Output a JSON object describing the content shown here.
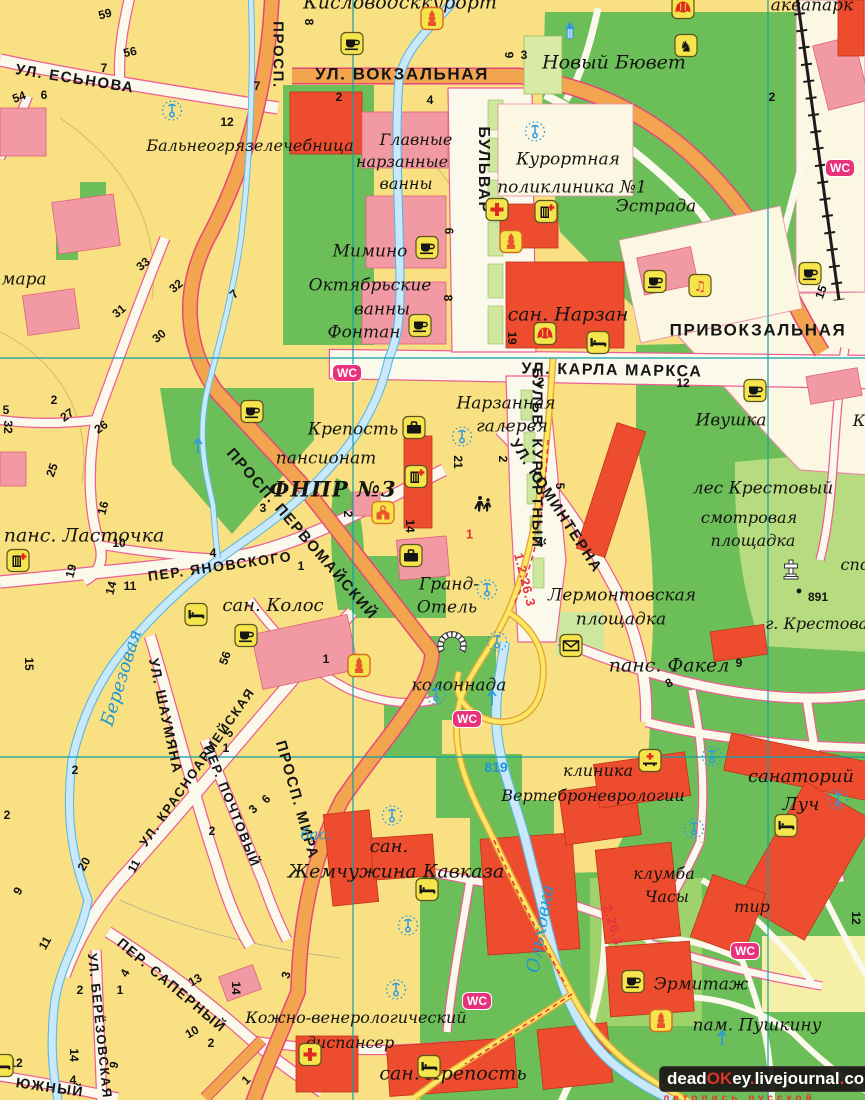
{
  "wc_label": "WC",
  "watermark": {
    "segments": [
      {
        "text": "dead",
        "color": "#ffffff"
      },
      {
        "text": "OK",
        "color": "#e03227"
      },
      {
        "text": "ey",
        "color": "#ffffff"
      },
      {
        "text": ".",
        "color": "#e03227"
      },
      {
        "text": "livejournal",
        "color": "#ffffff"
      },
      {
        "text": ".",
        "color": "#e03227"
      },
      {
        "text": "com",
        "color": "#ffffff"
      }
    ],
    "subtitle": "летопись русской усадьбы"
  },
  "streets": [
    {
      "id": "ul-esnova",
      "t": "УЛ. ЕСЬНОВА",
      "x": 75,
      "y": 79,
      "r": 9,
      "s": 15
    },
    {
      "id": "prosp-top",
      "t": "ПРОСП.",
      "x": 278,
      "y": 55,
      "r": 90,
      "s": 15
    },
    {
      "id": "ul-vokzalnaya",
      "t": "УЛ. ВОКЗАЛЬНАЯ",
      "x": 402,
      "y": 74,
      "r": 0,
      "s": 17
    },
    {
      "id": "bulvar",
      "t": "БУЛЬВАР",
      "x": 483,
      "y": 170,
      "r": 90,
      "s": 16
    },
    {
      "id": "bulv-kurortny",
      "t": "БУЛЬВ. КУРОРТНЫЙ",
      "x": 537,
      "y": 458,
      "r": 90,
      "s": 15
    },
    {
      "id": "ul-karla-marksa",
      "t": "УЛ. КАРЛА МАРКСА",
      "x": 612,
      "y": 371,
      "r": 1,
      "s": 16
    },
    {
      "id": "privokzalnaya",
      "t": "ПРИВОКЗАЛЬНАЯ",
      "x": 758,
      "y": 330,
      "r": 0,
      "s": 17
    },
    {
      "id": "ul-kominterna",
      "t": "УЛ. КОМИНТЕРНА",
      "x": 556,
      "y": 506,
      "r": 57,
      "s": 15
    },
    {
      "id": "prosp-pervomaisky",
      "t": "ПРОСП. ПЕРВОМАЙСКИЙ",
      "x": 302,
      "y": 534,
      "r": 49,
      "s": 15
    },
    {
      "id": "prosp-mira",
      "t": "ПРОСП. МИРА",
      "x": 297,
      "y": 800,
      "r": 74,
      "s": 15
    },
    {
      "id": "per-yanovskogo",
      "t": "ПЕР. ЯНОВСКОГО",
      "x": 220,
      "y": 566,
      "r": -8,
      "s": 14
    },
    {
      "id": "ul-shaumyana",
      "t": "УЛ. ШАУМЯНА",
      "x": 166,
      "y": 716,
      "r": 78,
      "s": 14
    },
    {
      "id": "ul-krasnoarmeyskaya",
      "t": "УЛ. КРАСНОАРМЕЙСКАЯ",
      "x": 197,
      "y": 767,
      "r": -55,
      "s": 13
    },
    {
      "id": "per-pochtovy",
      "t": "ПЕР. ПОЧТОВЫЙ",
      "x": 232,
      "y": 806,
      "r": 68,
      "s": 13
    },
    {
      "id": "per-saperny",
      "t": "ПЕР. САПЕРНЫЙ",
      "x": 172,
      "y": 985,
      "r": 40,
      "s": 14
    },
    {
      "id": "ul-berezovskaya",
      "t": "УЛ. БЕРЁЗОВСКАЯ",
      "x": 100,
      "y": 1026,
      "r": 84,
      "s": 13
    },
    {
      "id": "yuzhny",
      "t": "ЮЖНЫЙ",
      "x": 50,
      "y": 1087,
      "r": 8,
      "s": 14
    }
  ],
  "places": [
    {
      "id": "kislovodskkurort",
      "t": "Кисловодсккурорт",
      "x": 400,
      "y": 3,
      "s": 19
    },
    {
      "id": "balneo",
      "t": "Бальнеогрязелечебница",
      "x": 250,
      "y": 146,
      "s": 16
    },
    {
      "id": "glavnye",
      "t": "Главные",
      "x": 416,
      "y": 140,
      "s": 16
    },
    {
      "id": "narzannye",
      "t": "нарзанные",
      "x": 402,
      "y": 162,
      "s": 16
    },
    {
      "id": "vanny-1",
      "t": "ванны",
      "x": 406,
      "y": 184,
      "s": 16
    },
    {
      "id": "novy-byuvet",
      "t": "Новый Бювет",
      "x": 614,
      "y": 63,
      "s": 19
    },
    {
      "id": "akvapark",
      "t": "аквапарк",
      "x": 812,
      "y": 6,
      "s": 17
    },
    {
      "id": "kurortnaya",
      "t": "Курортная",
      "x": 568,
      "y": 160,
      "s": 17
    },
    {
      "id": "poliklinika",
      "t": "поликлиника №1",
      "x": 572,
      "y": 188,
      "s": 17
    },
    {
      "id": "estrada",
      "t": "Эстрада",
      "x": 656,
      "y": 207,
      "s": 17
    },
    {
      "id": "mimino",
      "t": "Мимино",
      "x": 370,
      "y": 252,
      "s": 17
    },
    {
      "id": "oktyabrskie",
      "t": "Октябрьские",
      "x": 370,
      "y": 286,
      "s": 17
    },
    {
      "id": "vanny-2",
      "t": "ванны",
      "x": 382,
      "y": 310,
      "s": 17
    },
    {
      "id": "fontan",
      "t": "Фонтан",
      "x": 364,
      "y": 333,
      "s": 17
    },
    {
      "id": "san-narzan",
      "t": "сан. Нарзан",
      "x": 568,
      "y": 315,
      "s": 19
    },
    {
      "id": "narzannaya",
      "t": "Нарзанная",
      "x": 506,
      "y": 404,
      "s": 17
    },
    {
      "id": "galereya",
      "t": "галерея",
      "x": 512,
      "y": 427,
      "s": 17
    },
    {
      "id": "ivushka",
      "t": "Ивушка",
      "x": 731,
      "y": 421,
      "s": 17
    },
    {
      "id": "les-krestovy",
      "t": "лес Крестовый",
      "x": 763,
      "y": 489,
      "s": 17
    },
    {
      "id": "krepost",
      "t": "Крепость",
      "x": 353,
      "y": 430,
      "s": 17
    },
    {
      "id": "pansionat",
      "t": "пансионат",
      "x": 326,
      "y": 459,
      "s": 17
    },
    {
      "id": "fnpr",
      "t": "ФНПР №3",
      "x": 333,
      "y": 489,
      "s": 21,
      "c": "place-bold"
    },
    {
      "id": "pans-lastochka",
      "t": "панс. Ласточка",
      "x": 84,
      "y": 536,
      "s": 19
    },
    {
      "id": "san-kolos",
      "t": "сан. Колос",
      "x": 273,
      "y": 606,
      "s": 18
    },
    {
      "id": "smotrovaya",
      "t": "смотровая",
      "x": 749,
      "y": 518,
      "s": 16
    },
    {
      "id": "ploshchadka-1",
      "t": "площадка",
      "x": 753,
      "y": 541,
      "s": 16
    },
    {
      "id": "grand",
      "t": "Гранд-",
      "x": 449,
      "y": 585,
      "s": 17
    },
    {
      "id": "otel",
      "t": "Отель",
      "x": 447,
      "y": 608,
      "s": 17
    },
    {
      "id": "lermontovskaya",
      "t": "Лермонтовская",
      "x": 622,
      "y": 596,
      "s": 17
    },
    {
      "id": "ploshchadka-2",
      "t": "площадка",
      "x": 621,
      "y": 620,
      "s": 17
    },
    {
      "id": "pans-fakel",
      "t": "панс. Факел",
      "x": 669,
      "y": 666,
      "s": 19
    },
    {
      "id": "kolonnada",
      "t": "колоннада",
      "x": 459,
      "y": 686,
      "s": 17
    },
    {
      "id": "klinika",
      "t": "клиника",
      "x": 598,
      "y": 771,
      "s": 16
    },
    {
      "id": "vertebro",
      "t": "Вертеброневрологии",
      "x": 593,
      "y": 796,
      "s": 16
    },
    {
      "id": "sanatoriy",
      "t": "санаторий",
      "x": 801,
      "y": 777,
      "s": 18
    },
    {
      "id": "luch",
      "t": "Луч",
      "x": 801,
      "y": 805,
      "s": 18
    },
    {
      "id": "klumba",
      "t": "клумба",
      "x": 664,
      "y": 874,
      "s": 16
    },
    {
      "id": "chasy",
      "t": "Часы",
      "x": 667,
      "y": 897,
      "s": 16
    },
    {
      "id": "tir",
      "t": "тир",
      "x": 752,
      "y": 907,
      "s": 16
    },
    {
      "id": "san-zh",
      "t": "сан.",
      "x": 389,
      "y": 847,
      "s": 18
    },
    {
      "id": "zhemchuzhina",
      "t": "Жемчужина Кавказа",
      "x": 396,
      "y": 872,
      "s": 19
    },
    {
      "id": "ermitazh",
      "t": "Эрмитаж",
      "x": 701,
      "y": 985,
      "s": 17
    },
    {
      "id": "pam-pushkinu",
      "t": "пам. Пушкину",
      "x": 757,
      "y": 1026,
      "s": 17
    },
    {
      "id": "kozhno",
      "t": "Кожно-венерологический",
      "x": 356,
      "y": 1018,
      "s": 16
    },
    {
      "id": "dispanser",
      "t": "диспансер",
      "x": 350,
      "y": 1043,
      "s": 16
    },
    {
      "id": "san-krepost",
      "t": "сан. Крепость",
      "x": 453,
      "y": 1074,
      "s": 19
    },
    {
      "id": "mara",
      "t": "мара",
      "x": 24,
      "y": 280,
      "s": 17
    },
    {
      "id": "g-krestovaya",
      "t": "г. Крестовая",
      "x": 822,
      "y": 624,
      "s": 16
    },
    {
      "id": "spo",
      "t": "спо",
      "x": 855,
      "y": 565,
      "s": 16
    },
    {
      "id": "k-fragment",
      "t": "К",
      "x": 859,
      "y": 421,
      "s": 16
    },
    {
      "id": "berezovaya",
      "t": "Березовая",
      "x": 122,
      "y": 678,
      "r": -73,
      "s": 18,
      "c": "river"
    },
    {
      "id": "olkhovka",
      "t": "Ольховка",
      "x": 541,
      "y": 929,
      "r": -80,
      "s": 18,
      "c": "river"
    },
    {
      "id": "bas",
      "t": "бас.",
      "x": 316,
      "y": 835,
      "s": 15,
      "c": "river"
    },
    {
      "id": "elev-819",
      "t": "819",
      "x": 496,
      "y": 767,
      "s": 14,
      "c": "elev"
    },
    {
      "id": "route-1-2-26-3",
      "t": "1.2.26.3",
      "x": 525,
      "y": 580,
      "r": 76,
      "s": 13,
      "c": "route"
    },
    {
      "id": "route-2-26-3",
      "t": "2.26.3",
      "x": 613,
      "y": 925,
      "r": 73,
      "s": 13,
      "c": "route"
    },
    {
      "id": "route-1",
      "t": "1",
      "x": 470,
      "y": 534,
      "r": 0,
      "s": 13,
      "c": "route"
    }
  ],
  "numbers": [
    [
      "59",
      105,
      14,
      -15
    ],
    [
      "56",
      130,
      52,
      -12
    ],
    [
      "7",
      104,
      68,
      0
    ],
    [
      "54",
      19,
      97,
      -20
    ],
    [
      "6",
      44,
      95,
      0
    ],
    [
      "7",
      257,
      86,
      0
    ],
    [
      "8",
      309,
      22,
      90
    ],
    [
      "12",
      227,
      122,
      0
    ],
    [
      "2",
      339,
      97,
      0
    ],
    [
      "4",
      430,
      100,
      0
    ],
    [
      "9",
      509,
      55,
      90
    ],
    [
      "3",
      524,
      55,
      0
    ],
    [
      "6",
      449,
      231,
      90
    ],
    [
      "8",
      448,
      298,
      90
    ],
    [
      "19",
      512,
      338,
      90
    ],
    [
      "2",
      772,
      97,
      0
    ],
    [
      "12",
      683,
      383,
      0
    ],
    [
      "2",
      541,
      382,
      0
    ],
    [
      "15",
      821,
      292,
      -70
    ],
    [
      "21",
      458,
      462,
      90
    ],
    [
      "2",
      503,
      459,
      90
    ],
    [
      "5",
      560,
      486,
      90
    ],
    [
      "4",
      540,
      543,
      0
    ],
    [
      "2",
      348,
      514,
      90
    ],
    [
      "14",
      410,
      526,
      90
    ],
    [
      "3",
      263,
      508,
      0
    ],
    [
      "4",
      213,
      553,
      0
    ],
    [
      "1",
      301,
      566,
      0
    ],
    [
      "3",
      251,
      631,
      0
    ],
    [
      "56",
      225,
      658,
      -70
    ],
    [
      "1",
      326,
      659,
      0
    ],
    [
      "2",
      54,
      400,
      0
    ],
    [
      "27",
      67,
      415,
      -35
    ],
    [
      "26",
      101,
      427,
      -35
    ],
    [
      "25",
      52,
      470,
      -70
    ],
    [
      "16",
      103,
      508,
      -75
    ],
    [
      "10",
      119,
      543,
      0
    ],
    [
      "19",
      71,
      571,
      -75
    ],
    [
      "14",
      111,
      588,
      -75
    ],
    [
      "11",
      130,
      586,
      0
    ],
    [
      "15",
      29,
      664,
      90
    ],
    [
      "2",
      75,
      770,
      0
    ],
    [
      "20",
      84,
      864,
      -60
    ],
    [
      "11",
      134,
      866,
      -60
    ],
    [
      "9",
      18,
      891,
      -60
    ],
    [
      "5",
      229,
      733,
      -45
    ],
    [
      "1",
      226,
      748,
      0
    ],
    [
      "6",
      266,
      799,
      -45
    ],
    [
      "3",
      253,
      809,
      -45
    ],
    [
      "2",
      212,
      831,
      0
    ],
    [
      "2",
      7,
      815,
      0
    ],
    [
      "11",
      45,
      943,
      -60
    ],
    [
      "12",
      16,
      1063,
      0
    ],
    [
      "14",
      74,
      1055,
      90
    ],
    [
      "4",
      73,
      1080,
      0
    ],
    [
      "2",
      80,
      990,
      0
    ],
    [
      "9",
      114,
      1065,
      -75
    ],
    [
      "4",
      125,
      973,
      -60
    ],
    [
      "1",
      120,
      990,
      0
    ],
    [
      "13",
      195,
      980,
      -30
    ],
    [
      "14",
      236,
      988,
      90
    ],
    [
      "10",
      192,
      1032,
      -30
    ],
    [
      "2",
      211,
      1043,
      0
    ],
    [
      "3",
      286,
      975,
      -75
    ],
    [
      "1",
      246,
      1080,
      -45
    ],
    [
      "12",
      856,
      918,
      90
    ],
    [
      "9",
      739,
      663,
      0
    ],
    [
      "8",
      669,
      683,
      -30
    ],
    [
      "33",
      143,
      264,
      -40
    ],
    [
      "32",
      176,
      286,
      -40
    ],
    [
      "31",
      119,
      311,
      -40
    ],
    [
      "30",
      159,
      336,
      -40
    ],
    [
      "7",
      234,
      294,
      -45
    ],
    [
      "5",
      6,
      410,
      0
    ],
    [
      "32",
      8,
      427,
      90
    ],
    [
      "891",
      818,
      597,
      0
    ]
  ],
  "icons": [
    [
      "coffee",
      352,
      46
    ],
    [
      "coffee",
      427,
      250
    ],
    [
      "coffee",
      420,
      328
    ],
    [
      "coffee",
      655,
      284
    ],
    [
      "coffee",
      252,
      414
    ],
    [
      "coffee",
      246,
      638
    ],
    [
      "coffee",
      810,
      276
    ],
    [
      "coffee",
      633,
      984
    ],
    [
      "coffee",
      755,
      393
    ],
    [
      "theater",
      683,
      10
    ],
    [
      "theater",
      545,
      336
    ],
    [
      "bed",
      598,
      345
    ],
    [
      "bed",
      196,
      617
    ],
    [
      "bed",
      786,
      828
    ],
    [
      "bed",
      427,
      892
    ],
    [
      "bed",
      429,
      1069
    ],
    [
      "bed",
      2,
      1068
    ],
    [
      "cross",
      497,
      212
    ],
    [
      "cross",
      310,
      1057
    ],
    [
      "medbuilding",
      546,
      214
    ],
    [
      "medbuilding",
      416,
      479
    ],
    [
      "medbuilding",
      18,
      563
    ],
    [
      "medbed",
      650,
      763
    ],
    [
      "tower",
      432,
      21
    ],
    [
      "tower",
      511,
      244
    ],
    [
      "tower",
      359,
      668
    ],
    [
      "tower",
      661,
      1023
    ],
    [
      "bluetower",
      570,
      34
    ],
    [
      "music",
      700,
      288
    ],
    [
      "horse",
      686,
      48
    ],
    [
      "envelope",
      571,
      648
    ],
    [
      "suitcase",
      414,
      430
    ],
    [
      "suitcase",
      411,
      558
    ],
    [
      "school",
      383,
      515
    ],
    [
      "wc",
      347,
      373
    ],
    [
      "wc",
      840,
      168
    ],
    [
      "wc",
      467,
      719
    ],
    [
      "wc",
      745,
      951
    ],
    [
      "wc",
      477,
      1001
    ],
    [
      "fountain",
      172,
      113
    ],
    [
      "fountain",
      535,
      134
    ],
    [
      "fountain",
      462,
      439
    ],
    [
      "fountain",
      487,
      592
    ],
    [
      "fountain",
      497,
      644
    ],
    [
      "fountain",
      436,
      697
    ],
    [
      "fountain",
      712,
      759
    ],
    [
      "fountain",
      694,
      831
    ],
    [
      "fountain",
      392,
      818
    ],
    [
      "fountain",
      408,
      928
    ],
    [
      "fountain",
      396,
      992
    ],
    [
      "fountain",
      838,
      802
    ],
    [
      "pedestrians",
      484,
      508
    ],
    [
      "crossmon",
      791,
      572
    ],
    [
      "colonnade",
      452,
      643
    ],
    [
      "flowarrow",
      198,
      448
    ],
    [
      "flowarrow",
      492,
      700
    ],
    [
      "flowarrow",
      722,
      1040
    ],
    [
      "dot",
      799,
      591
    ]
  ]
}
